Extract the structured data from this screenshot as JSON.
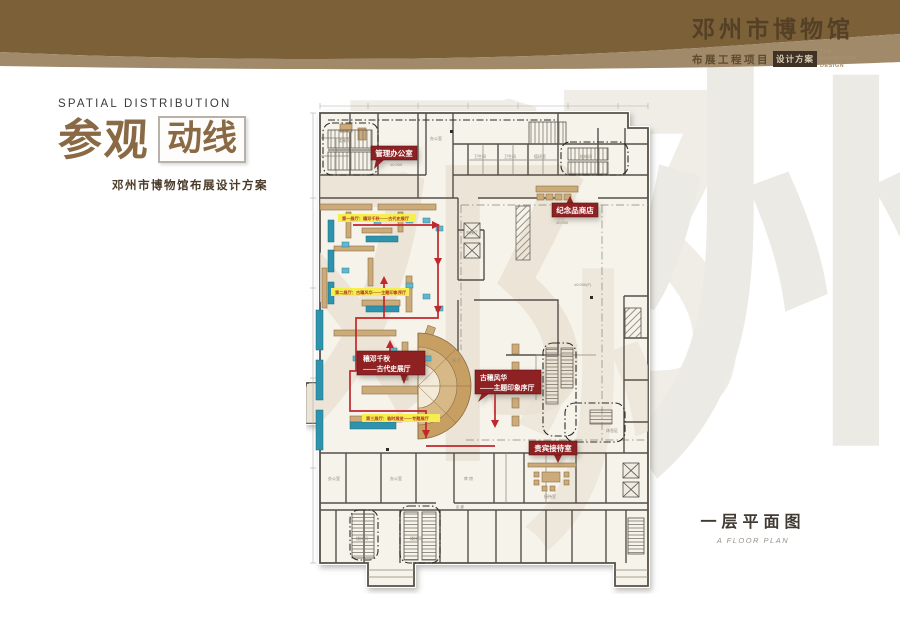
{
  "header": {
    "museum_title": "邓州市博物馆",
    "project_label": "布展工程项目",
    "badge_label": "设计方案",
    "subtitle_en": "THE EXHIBITION DESIGN",
    "colors": {
      "bar_dark": "#7b6038",
      "bar_light": "#a18a6a",
      "badge_bg": "#3e3226"
    }
  },
  "title_block": {
    "eyebrow": "SPATIAL DISTRIBUTION",
    "title_main": "参观",
    "title_boxed": "动线",
    "subtitle": "邓州市博物馆布展设计方案"
  },
  "watermark": {
    "char_left": "邓",
    "char_right": "州"
  },
  "plan": {
    "caption": "一层平面图",
    "caption_en": "A FLOOR PLAN",
    "colors": {
      "route_red": "#c1272d",
      "label_red": "#8e2023",
      "wall_gray": "#57504a",
      "partition_tan": "#cbab79",
      "case_blue": "#5fb7d0",
      "counter_teal": "#2e93ac",
      "tag_yellow": "#f6ee4e"
    },
    "labels": {
      "office": "管理办公室",
      "souvenir": "纪念品商店",
      "ancient_line1": "穰邓千秋",
      "ancient_line2": "——古代史展厅",
      "prelude_line1": "古穰风华",
      "prelude_line2": "——主题印象序厅",
      "vip": "贵宾接待室"
    },
    "tags": {
      "tag1": "第一展厅：穰邓千秋——古代史展厅",
      "tag2": "第二展厅：古穰风华——主题印象序厅",
      "tag3": "第三展厅：临时展览——专题展厅"
    },
    "annotations": [
      "楼梯间",
      "办公室",
      "卫生间",
      "±0.000",
      "±0.000(F)",
      "走 廊",
      "电梯厅",
      "库 房",
      "值班室",
      "接待室",
      "序 厅",
      "休息区"
    ]
  }
}
